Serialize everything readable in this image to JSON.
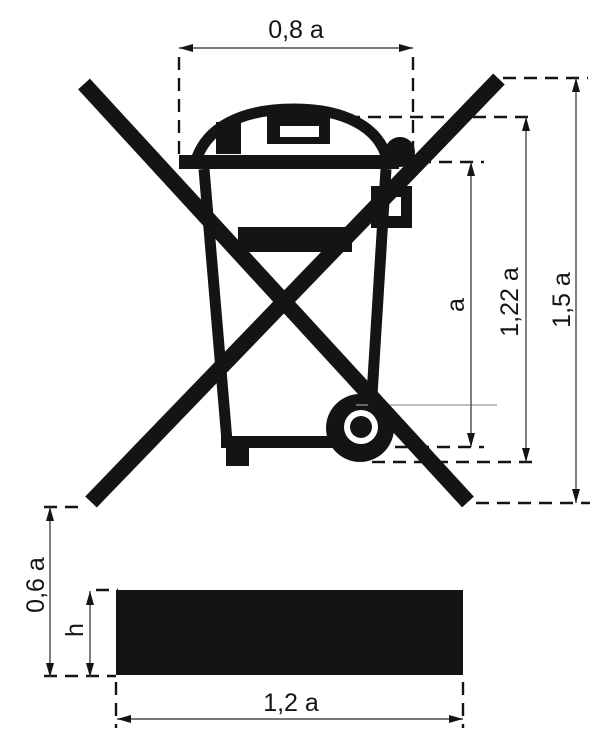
{
  "figure": {
    "type": "technical-drawing",
    "symbol": "crossed-out wheeled bin marking with solid black bar underneath",
    "decimal_style": "comma"
  },
  "colors": {
    "ink": "#141414",
    "paper": "#ffffff",
    "dim": "#4a4a4a"
  },
  "dimensions": {
    "lid_width": "0,8 a",
    "bin_height": "a",
    "lid_top_height": "1,22 a",
    "overall_height": "1,5 a",
    "bar_gap": "0,6 a",
    "bar_thickness": "h",
    "bar_width": "1,2 a"
  }
}
